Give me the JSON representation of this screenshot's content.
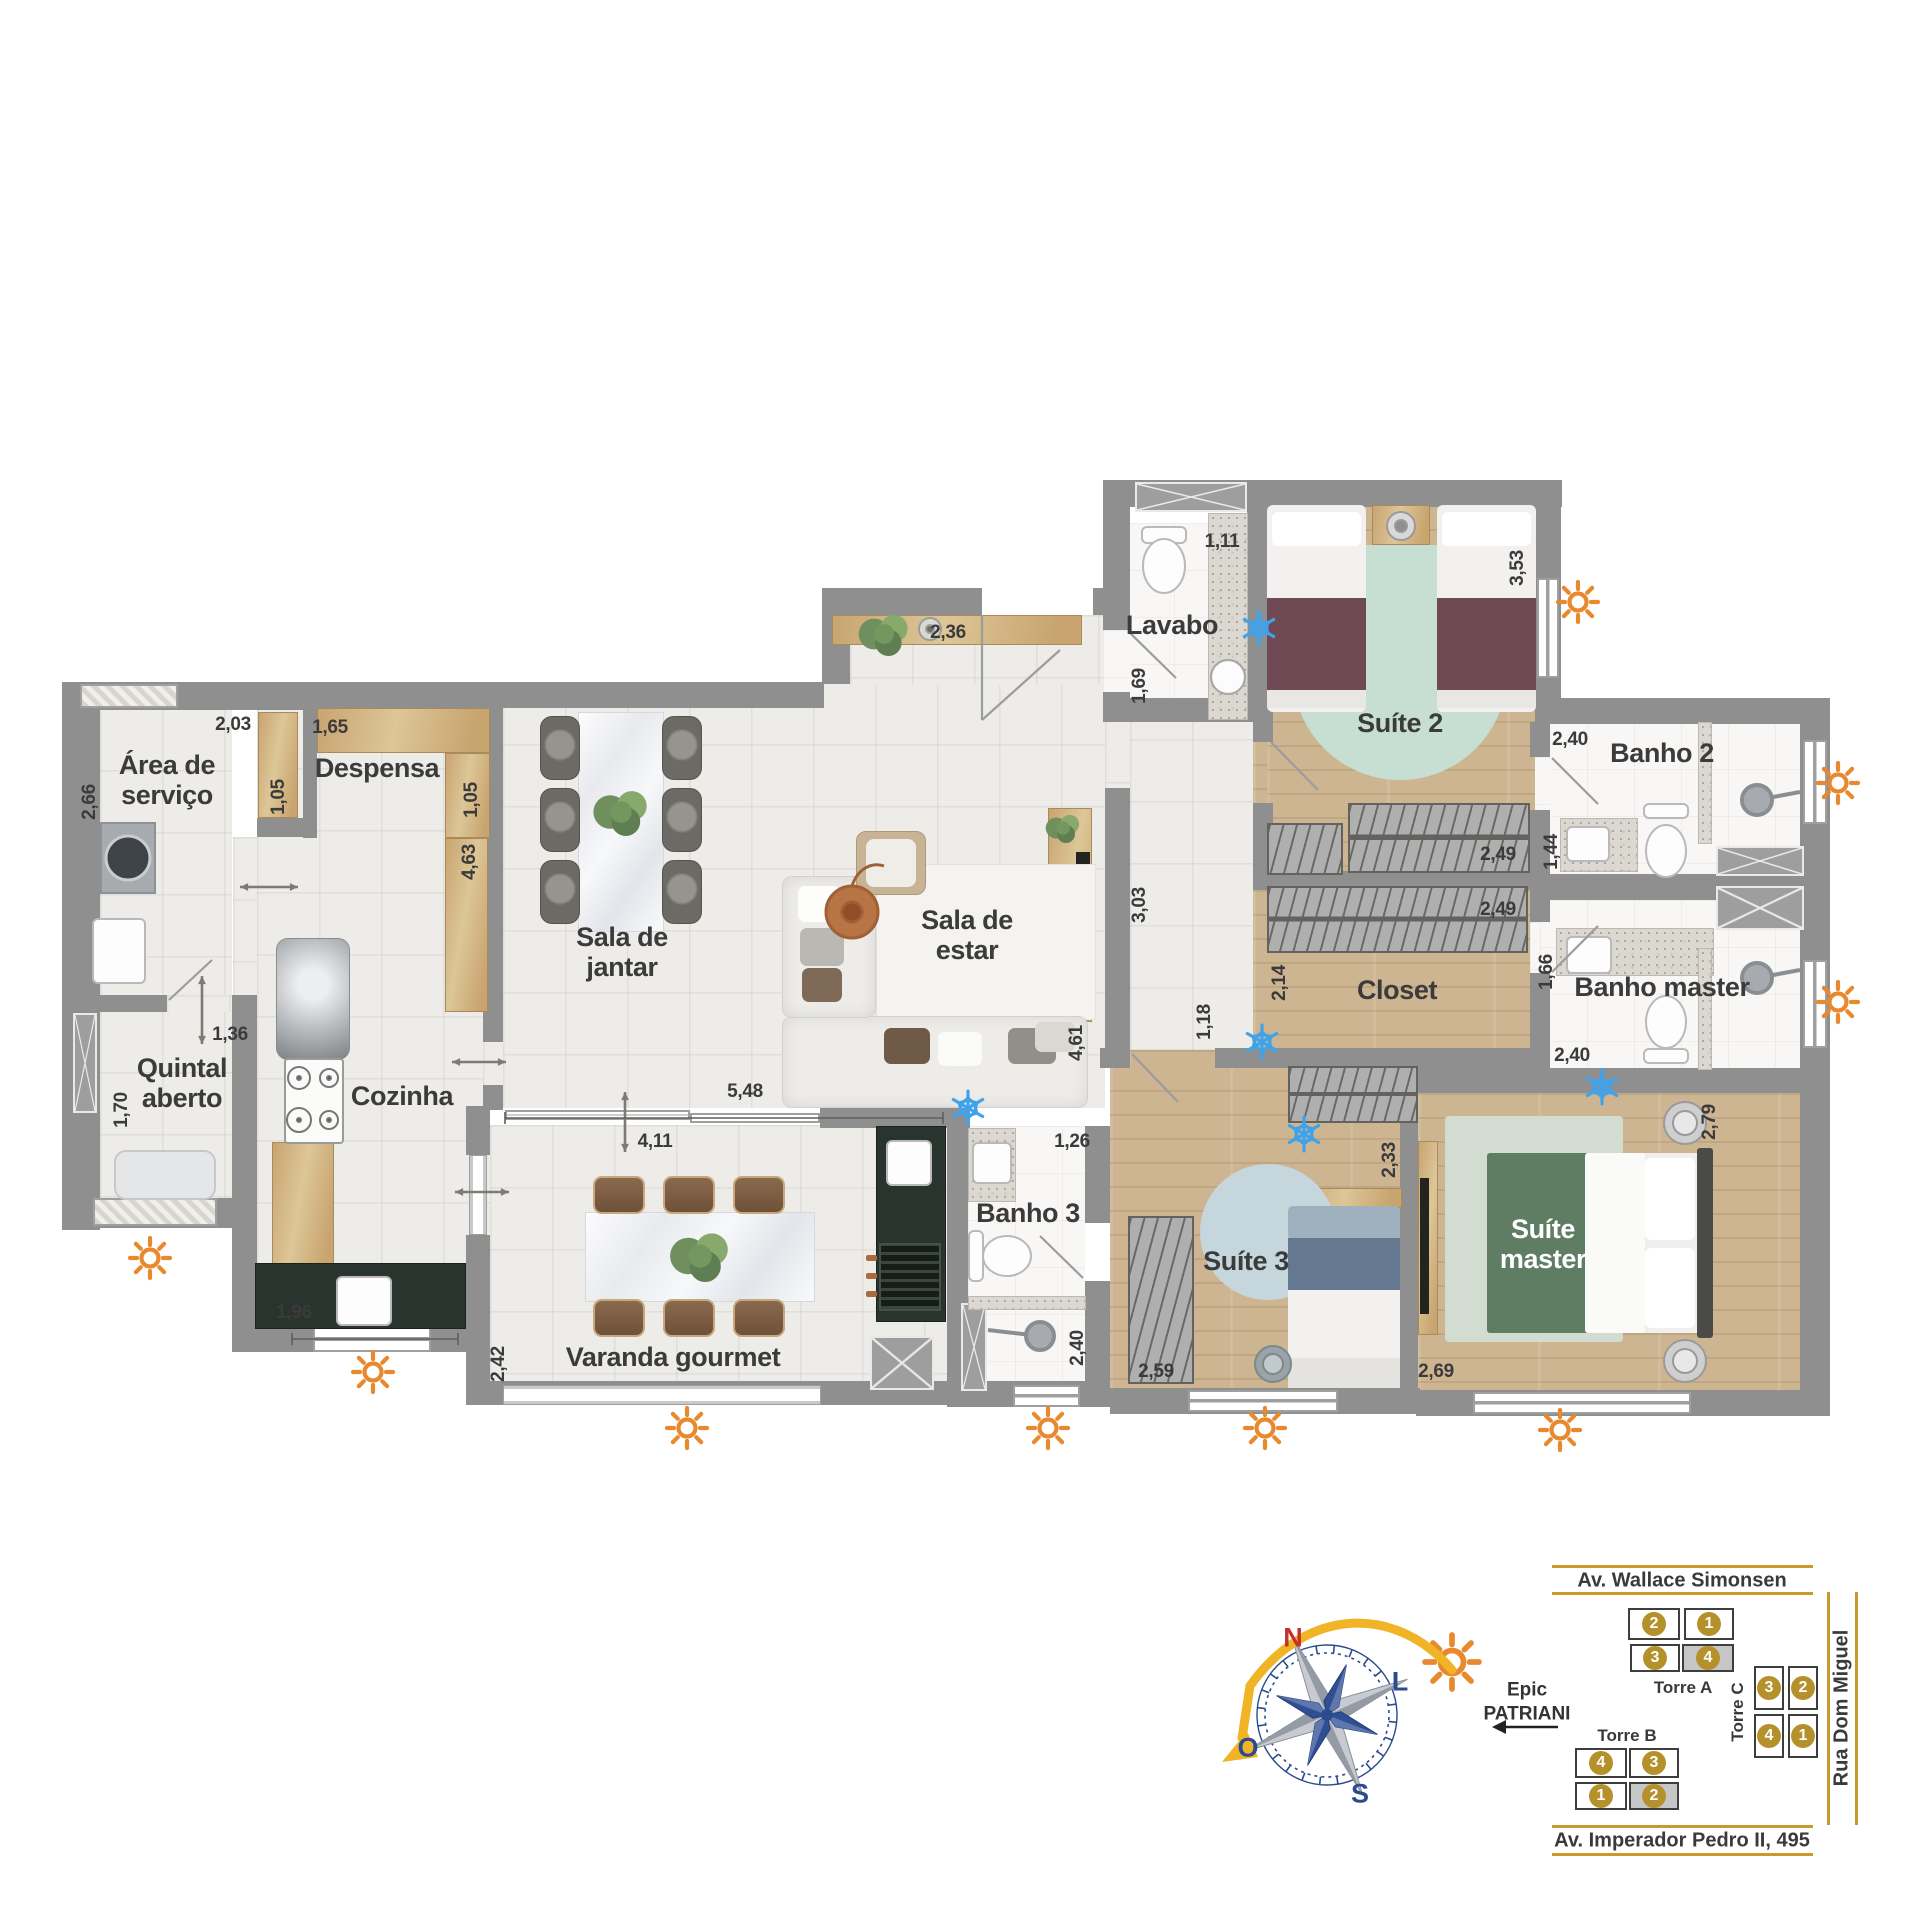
{
  "rooms": [
    {
      "id": "area-servico",
      "label": "Área de\nserviço",
      "x": 167,
      "y": 780
    },
    {
      "id": "despensa",
      "label": "Despensa",
      "x": 377,
      "y": 768
    },
    {
      "id": "sala-jantar",
      "label": "Sala de\njantar",
      "x": 622,
      "y": 952
    },
    {
      "id": "sala-estar",
      "label": "Sala de\nestar",
      "x": 967,
      "y": 935
    },
    {
      "id": "lavabo",
      "label": "Lavabo",
      "x": 1172,
      "y": 625
    },
    {
      "id": "suite-2",
      "label": "Suíte 2",
      "x": 1400,
      "y": 723
    },
    {
      "id": "banho-2",
      "label": "Banho 2",
      "x": 1662,
      "y": 753
    },
    {
      "id": "closet",
      "label": "Closet",
      "x": 1397,
      "y": 990
    },
    {
      "id": "banho-master",
      "label": "Banho master",
      "x": 1662,
      "y": 987
    },
    {
      "id": "quintal-aberto",
      "label": "Quintal\naberto",
      "x": 182,
      "y": 1083
    },
    {
      "id": "cozinha",
      "label": "Cozinha",
      "x": 402,
      "y": 1096
    },
    {
      "id": "varanda-gourmet",
      "label": "Varanda gourmet",
      "x": 673,
      "y": 1357
    },
    {
      "id": "banho-3",
      "label": "Banho 3",
      "x": 1028,
      "y": 1213
    },
    {
      "id": "suite-3",
      "label": "Suíte 3",
      "x": 1246,
      "y": 1261
    },
    {
      "id": "suite-master",
      "label": "Suíte\nmaster",
      "x": 1543,
      "y": 1244,
      "light": true
    }
  ],
  "dims": [
    {
      "v": "2,03",
      "x": 233,
      "y": 725,
      "o": "h"
    },
    {
      "v": "2,66",
      "x": 90,
      "y": 802,
      "o": "v"
    },
    {
      "v": "1,05",
      "x": 279,
      "y": 797,
      "o": "v"
    },
    {
      "v": "1,65",
      "x": 330,
      "y": 728,
      "o": "h"
    },
    {
      "v": "1,05",
      "x": 472,
      "y": 800,
      "o": "v"
    },
    {
      "v": "4,63",
      "x": 470,
      "y": 862,
      "o": "v"
    },
    {
      "v": "2,36",
      "x": 948,
      "y": 633,
      "o": "h"
    },
    {
      "v": "1,11",
      "x": 1222,
      "y": 542,
      "o": "h"
    },
    {
      "v": "1,69",
      "x": 1140,
      "y": 686,
      "o": "v"
    },
    {
      "v": "3,53",
      "x": 1518,
      "y": 568,
      "o": "v"
    },
    {
      "v": "2,40",
      "x": 1570,
      "y": 740,
      "o": "h"
    },
    {
      "v": "1,44",
      "x": 1552,
      "y": 852,
      "o": "v"
    },
    {
      "v": "2,49",
      "x": 1498,
      "y": 855,
      "o": "h"
    },
    {
      "v": "2,49",
      "x": 1498,
      "y": 910,
      "o": "h"
    },
    {
      "v": "2,14",
      "x": 1280,
      "y": 983,
      "o": "v"
    },
    {
      "v": "1,66",
      "x": 1547,
      "y": 972,
      "o": "v"
    },
    {
      "v": "2,40",
      "x": 1572,
      "y": 1056,
      "o": "h"
    },
    {
      "v": "3,03",
      "x": 1140,
      "y": 905,
      "o": "v"
    },
    {
      "v": "4,61",
      "x": 1077,
      "y": 1043,
      "o": "v"
    },
    {
      "v": "5,48",
      "x": 745,
      "y": 1092,
      "o": "h"
    },
    {
      "v": "4,11",
      "x": 655,
      "y": 1142,
      "o": "h"
    },
    {
      "v": "1,18",
      "x": 1205,
      "y": 1022,
      "o": "v"
    },
    {
      "v": "1,36",
      "x": 230,
      "y": 1035,
      "o": "h"
    },
    {
      "v": "1,70",
      "x": 122,
      "y": 1110,
      "o": "v"
    },
    {
      "v": "1,96",
      "x": 294,
      "y": 1313,
      "o": "h"
    },
    {
      "v": "2,42",
      "x": 499,
      "y": 1364,
      "o": "v"
    },
    {
      "v": "1,26",
      "x": 1072,
      "y": 1142,
      "o": "h"
    },
    {
      "v": "2,40",
      "x": 1078,
      "y": 1348,
      "o": "v"
    },
    {
      "v": "2,33",
      "x": 1390,
      "y": 1160,
      "o": "v"
    },
    {
      "v": "2,59",
      "x": 1156,
      "y": 1372,
      "o": "h"
    },
    {
      "v": "2,69",
      "x": 1436,
      "y": 1372,
      "o": "h"
    },
    {
      "v": "2,79",
      "x": 1710,
      "y": 1122,
      "o": "v"
    }
  ],
  "icons": {
    "suns": [
      [
        1578,
        602
      ],
      [
        1838,
        783
      ],
      [
        1838,
        1002
      ],
      [
        1560,
        1430
      ],
      [
        1265,
        1428
      ],
      [
        1048,
        1428
      ],
      [
        687,
        1428
      ],
      [
        373,
        1372
      ],
      [
        150,
        1258
      ]
    ],
    "snows": [
      [
        1259,
        628
      ],
      [
        968,
        1108
      ],
      [
        1262,
        1042
      ],
      [
        1304,
        1134
      ],
      [
        1602,
        1087
      ]
    ]
  },
  "compass": {
    "n": "N",
    "e": "L",
    "s": "S",
    "w": "O",
    "cx": 1327,
    "cy": 1715,
    "sun": [
      1452,
      1662
    ]
  },
  "annotation": {
    "line1": "Epic",
    "line2": "PATRIANI"
  },
  "sitemap": {
    "streets": {
      "top": "Av. Wallace Simonsen",
      "right": "Rua Dom Miguel",
      "bottom": "Av. Imperador Pedro II, 495"
    },
    "towers": [
      {
        "name": "Torre A",
        "lx": 1683,
        "ly": 1688,
        "rot": false,
        "units": [
          {
            "n": "2",
            "x": 1628,
            "y": 1608,
            "w": 52,
            "h": 32,
            "hl": false
          },
          {
            "n": "1",
            "x": 1684,
            "y": 1608,
            "w": 50,
            "h": 32,
            "hl": false
          },
          {
            "n": "3",
            "x": 1630,
            "y": 1644,
            "w": 50,
            "h": 28,
            "hl": false
          },
          {
            "n": "4",
            "x": 1682,
            "y": 1644,
            "w": 52,
            "h": 28,
            "hl": true
          }
        ]
      },
      {
        "name": "Torre B",
        "lx": 1627,
        "ly": 1736,
        "rot": false,
        "units": [
          {
            "n": "4",
            "x": 1575,
            "y": 1748,
            "w": 52,
            "h": 30,
            "hl": false
          },
          {
            "n": "3",
            "x": 1629,
            "y": 1748,
            "w": 50,
            "h": 30,
            "hl": false
          },
          {
            "n": "1",
            "x": 1575,
            "y": 1782,
            "w": 52,
            "h": 28,
            "hl": false
          },
          {
            "n": "2",
            "x": 1629,
            "y": 1782,
            "w": 50,
            "h": 28,
            "hl": true
          }
        ]
      },
      {
        "name": "Torre C",
        "lx": 1738,
        "ly": 1712,
        "rot": true,
        "units": [
          {
            "n": "3",
            "x": 1754,
            "y": 1666,
            "w": 30,
            "h": 44,
            "hl": false
          },
          {
            "n": "2",
            "x": 1788,
            "y": 1666,
            "w": 30,
            "h": 44,
            "hl": false
          },
          {
            "n": "4",
            "x": 1754,
            "y": 1714,
            "w": 30,
            "h": 44,
            "hl": false
          },
          {
            "n": "1",
            "x": 1788,
            "y": 1714,
            "w": 30,
            "h": 44,
            "hl": false
          }
        ]
      }
    ]
  }
}
